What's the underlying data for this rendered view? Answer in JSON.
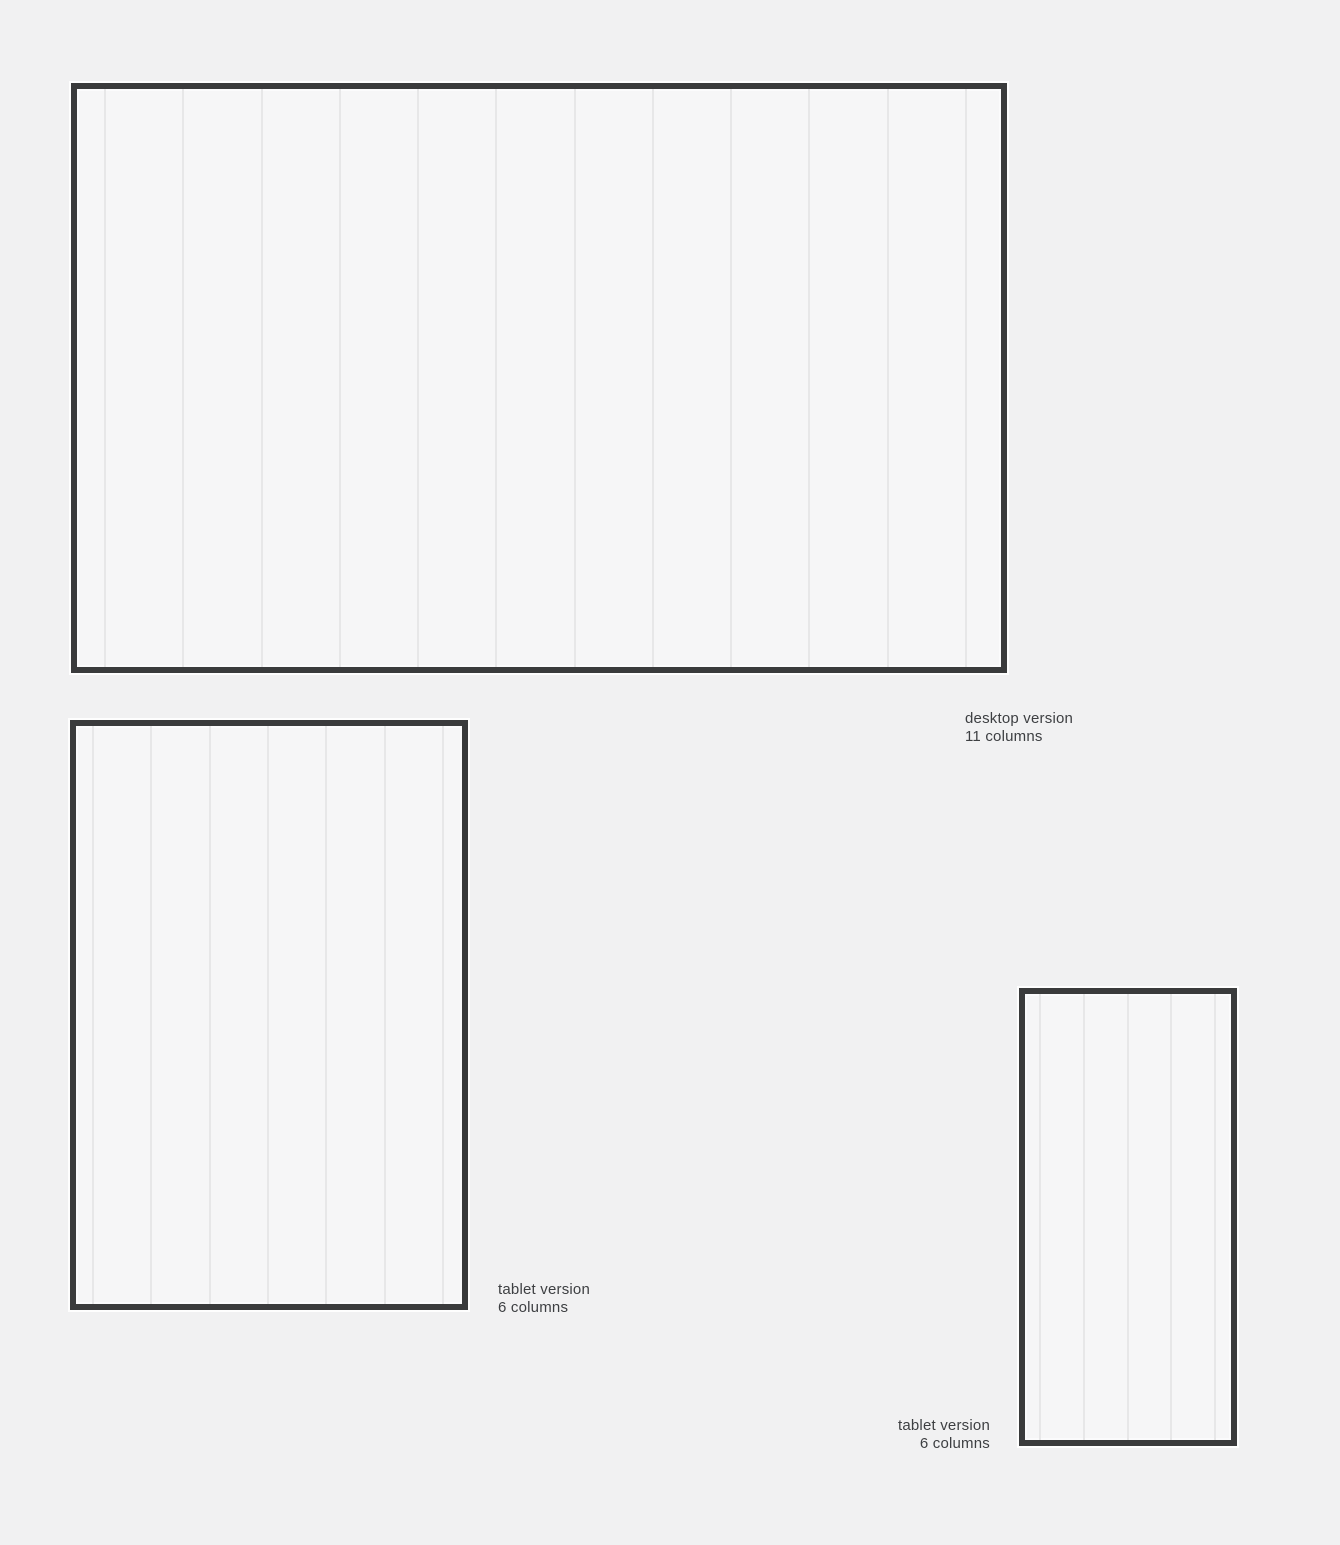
{
  "page": {
    "background_color": "#f1f1f2",
    "frame_border_color": "#3a3b3c",
    "frame_fill_color": "#f6f6f7",
    "grid_line_color": "#e7e7e8",
    "label_text_color": "#3d3f42"
  },
  "frames": [
    {
      "name": "desktop",
      "label_line1": "desktop version",
      "label_line2": "11 columns",
      "columns_label": 11
    },
    {
      "name": "tablet-large",
      "label_line1": "tablet version",
      "label_line2": "6 columns",
      "columns_label": 6
    },
    {
      "name": "tablet-small",
      "label_line1": "tablet version",
      "label_line2": "6 columns",
      "columns_label": 6
    }
  ]
}
